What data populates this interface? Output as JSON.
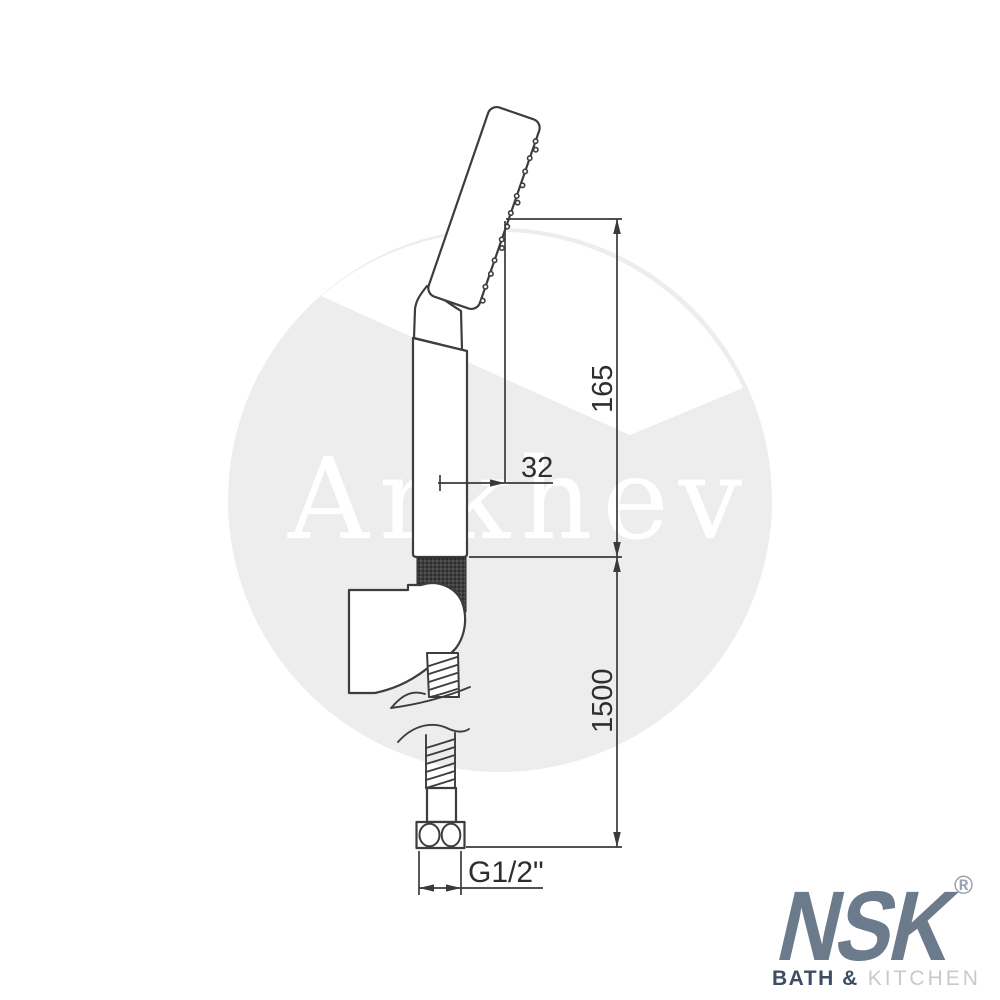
{
  "watermark": {
    "text": "Arkhev"
  },
  "dimensions": {
    "head_offset": "32",
    "upper_length": "165",
    "hose_length": "1500",
    "thread_size": "G1/2\""
  },
  "logo": {
    "brand": "NSK",
    "registered_mark": "®",
    "tagline_bold": "BATH &",
    "tagline_light": "KITCHEN"
  },
  "colors": {
    "background": "#ffffff",
    "drawing_line": "#3d3d3d",
    "watermark_fill": "#ededee",
    "brand_primary": "#6b7b8c",
    "brand_dark": "#3e4d63",
    "brand_light": "#c7cacd"
  }
}
